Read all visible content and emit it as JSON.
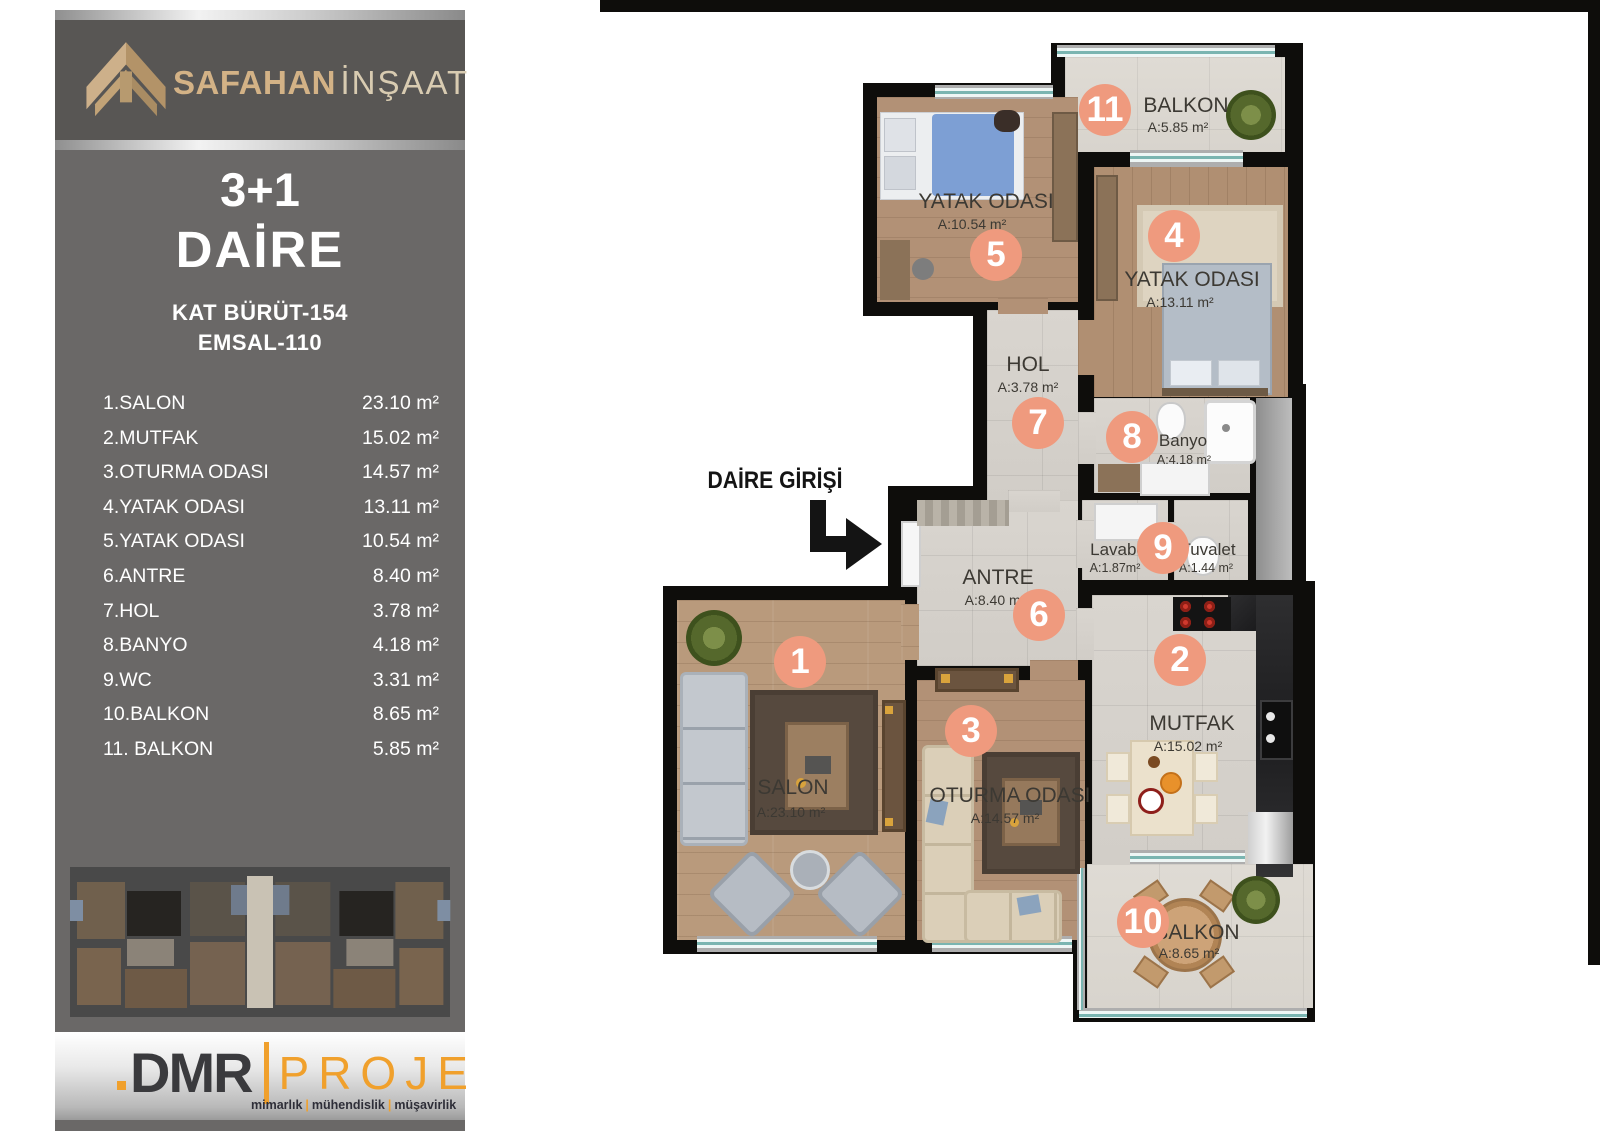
{
  "sidebar": {
    "brand": {
      "primary": "SAFAHAN",
      "secondary": "İNŞAAT"
    },
    "title_line1": "3+1",
    "title_line2": "DAİRE",
    "stat_line1": "KAT BÜRÜT-154",
    "stat_line2": "EMSAL-110",
    "rooms": [
      {
        "label": "1.SALON",
        "value": "23.10 m²"
      },
      {
        "label": "2.MUTFAK",
        "value": "15.02 m²"
      },
      {
        "label": "3.OTURMA ODASI",
        "value": "14.57 m²"
      },
      {
        "label": "4.YATAK ODASI",
        "value": "13.11 m²"
      },
      {
        "label": "5.YATAK ODASI",
        "value": "10.54 m²"
      },
      {
        "label": "6.ANTRE",
        "value": "8.40 m²"
      },
      {
        "label": "7.HOL",
        "value": "3.78 m²"
      },
      {
        "label": "8.BANYO",
        "value": "4.18 m²"
      },
      {
        "label": "9.WC",
        "value": "3.31 m²"
      },
      {
        "label": "10.BALKON",
        "value": "8.65 m²"
      },
      {
        "label": "11. BALKON",
        "value": "5.85 m²"
      }
    ]
  },
  "footer": {
    "logo_primary": "DMR",
    "logo_secondary": "PROJE",
    "tagline": [
      "mimarlık",
      "mühendislik",
      "müşavirlik"
    ]
  },
  "plan": {
    "entrance_label": "DAİRE GİRİŞİ",
    "rooms": [
      {
        "number": "1",
        "name": "SALON",
        "area": "A:23.10 m²"
      },
      {
        "number": "2",
        "name": "MUTFAK",
        "area": "A:15.02 m²"
      },
      {
        "number": "3",
        "name": "OTURMA ODASI",
        "area": "A:14.57 m²"
      },
      {
        "number": "4",
        "name": "YATAK ODASI",
        "area": "A:13.11 m²"
      },
      {
        "number": "5",
        "name": "YATAK ODASI",
        "area": "A:10.54 m²"
      },
      {
        "number": "6",
        "name": "ANTRE",
        "area": "A:8.40 m²"
      },
      {
        "number": "7",
        "name": "HOL",
        "area": "A:3.78 m²"
      },
      {
        "number": "8",
        "name": "Banyo",
        "area": "A:4.18 m²"
      },
      {
        "number": "9",
        "name": "Lavabo",
        "area": "A:1.87m²"
      },
      {
        "name": "Tuvalet",
        "area": "A:1.44 m²"
      },
      {
        "number": "10",
        "name": "BALKON",
        "area": "A:8.65 m²"
      },
      {
        "number": "11",
        "name": "BALKON",
        "area": "A:5.85 m²"
      }
    ],
    "colors": {
      "number_circle": "#ef9a7e",
      "wall": "#0e0d0b",
      "brand_gold": "#d3b286",
      "logo_orange": "#f0a02c"
    }
  }
}
